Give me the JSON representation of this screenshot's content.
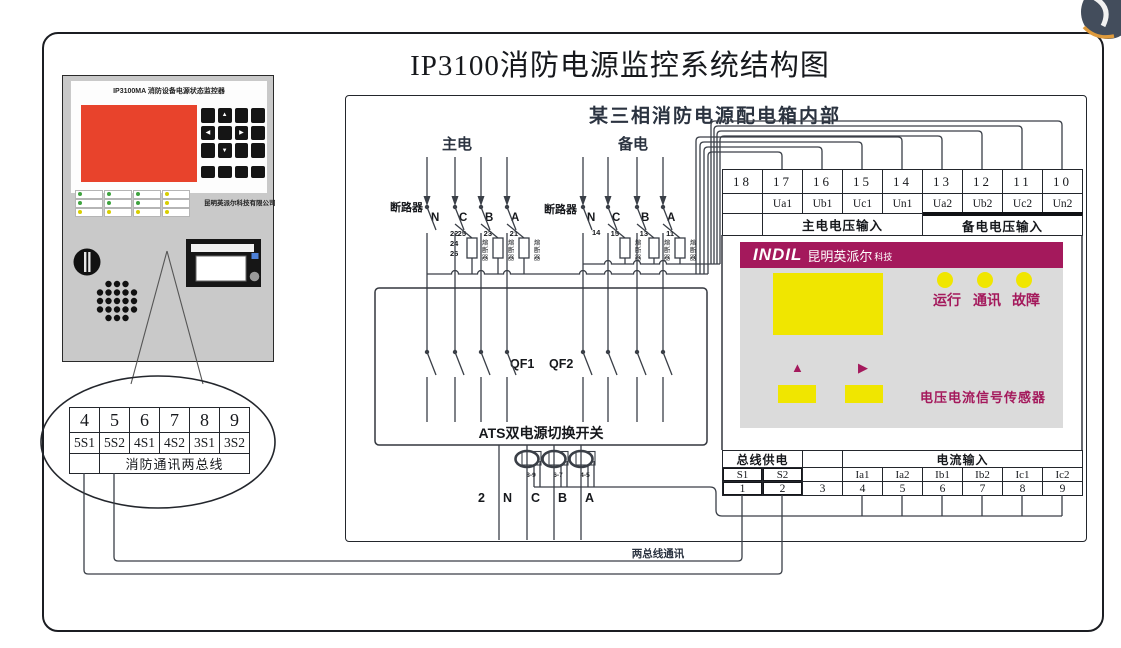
{
  "page_title": "IP3100消防电源监控系统结构图",
  "inner_box": {
    "title": "某三相消防电源配电箱内部"
  },
  "monitor_device": {
    "title": "IP3100MA 消防设备电源状态监控器",
    "company": "昆明英派尔科技有限公司",
    "arrows": {
      "up": "▲",
      "down": "▼",
      "left": "◀",
      "right": "▶"
    }
  },
  "fire_bus_terminal": {
    "numbers": [
      "4",
      "5",
      "6",
      "7",
      "8",
      "9"
    ],
    "codes": [
      "5S1",
      "5S2",
      "4S1",
      "4S2",
      "3S1",
      "3S2"
    ],
    "caption": "消防通讯两总线"
  },
  "main_power": {
    "label": "主电",
    "breaker": "断路器",
    "phases": [
      "N",
      "C",
      "B",
      "A"
    ],
    "n_wire_numbers": "22\n24\n26",
    "fuse_numbers": [
      "25",
      "23",
      "21"
    ],
    "fuse_word": "熔断器"
  },
  "backup_power": {
    "label": "备电",
    "breaker": "断路器",
    "phases": [
      "N",
      "C",
      "B",
      "A"
    ],
    "n_wire_number": "14",
    "fuse_numbers": [
      "15",
      "13",
      "11"
    ],
    "fuse_word": "熔断器"
  },
  "ats": {
    "label": "ATS双电源切换开关",
    "qf1": "QF1",
    "qf2": "QF2",
    "output_prefix": "2",
    "outputs": [
      "N",
      "C",
      "B",
      "A"
    ],
    "ct_labels": [
      "8-9",
      "6-7",
      "4-5"
    ]
  },
  "voltage_terminal": {
    "numbers": [
      "18",
      "17",
      "16",
      "15",
      "14",
      "13",
      "12",
      "11",
      "10"
    ],
    "signals": [
      "",
      "Ua1",
      "Ub1",
      "Uc1",
      "Un1",
      "Ua2",
      "Ub2",
      "Uc2",
      "Un2"
    ],
    "main_label": "主电电压输入",
    "backup_label": "备电电压输入"
  },
  "sensor": {
    "brand": "INDIL",
    "brand_cn": "昆明英派尔",
    "brand_suffix": "科技",
    "leds": [
      "运行",
      "通讯",
      "故障"
    ],
    "up_arrow": "▲",
    "right_arrow": "▶",
    "name": "电压电流信号传感器"
  },
  "current_terminal": {
    "power_label": "总线供电",
    "current_label": "电流输入",
    "signals": [
      "S1",
      "S2",
      "",
      "Ia1",
      "Ia2",
      "Ib1",
      "Ib2",
      "Ic1",
      "Ic2"
    ],
    "numbers": [
      "1",
      "2",
      "3",
      "4",
      "5",
      "6",
      "7",
      "8",
      "9"
    ]
  },
  "bus_comm_label": "两总线通讯",
  "colors": {
    "accent_magenta": "#A4195C",
    "led_yellow": "#F0E600",
    "display_red": "#E8432C",
    "device_gray": "#C9C9C9",
    "wire": "#3A3F47"
  }
}
